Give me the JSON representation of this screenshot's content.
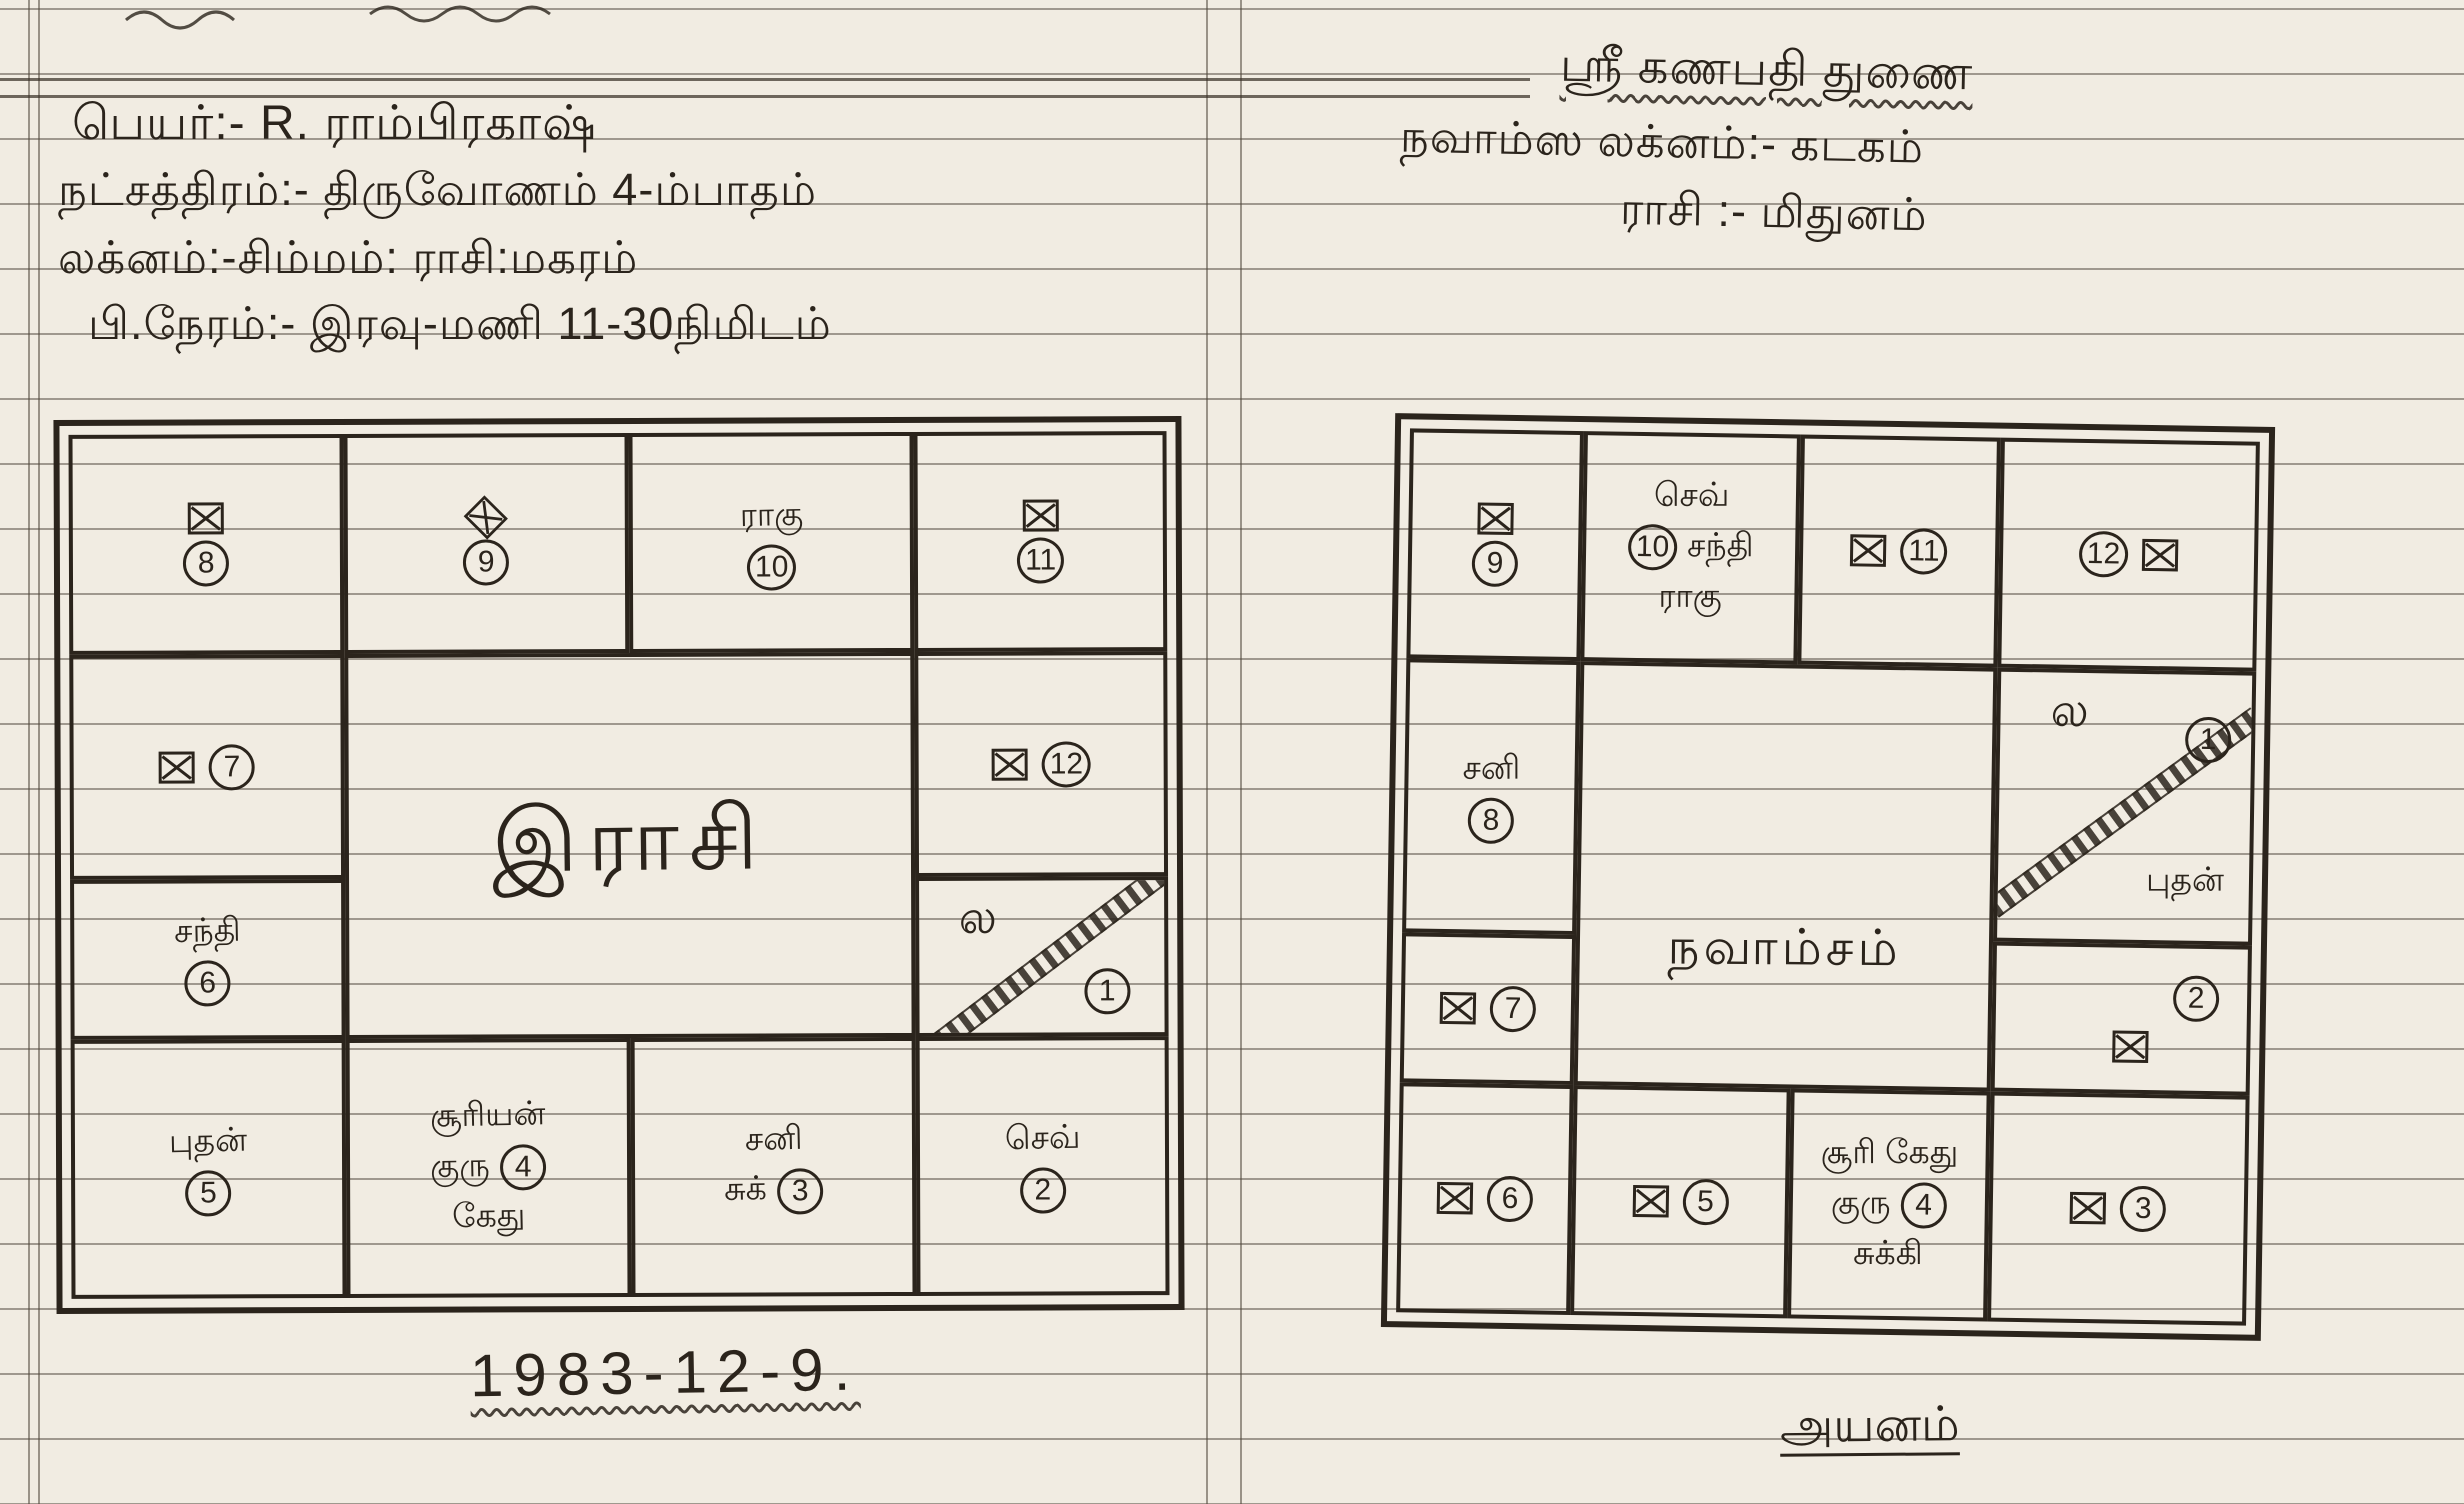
{
  "paper": {
    "background_color": "#f1ece2",
    "rule_line_color": "#4e453a",
    "ink_color": "#2b241c"
  },
  "left_page": {
    "header": {
      "line1": "பெயர்:- R. ராம்பிரகாஷ்",
      "line2": "நட்சத்திரம்:- திருவோணம் 4-ம்பாதம்",
      "line3": "லக்னம்:-சிம்மம்:   ராசி:மகரம்",
      "line4": "பி.நேரம்:- இரவு-மணி 11-30நிமிடம்"
    },
    "chart": {
      "center": "இராசி",
      "r1c1": {
        "num": "8"
      },
      "r1c2": {
        "num": "9"
      },
      "r1c3": {
        "planet": "ராகு",
        "num": "10"
      },
      "r1c4": {
        "num": "11"
      },
      "r2c1": {
        "num": "7"
      },
      "r2c4": {
        "num": "12"
      },
      "r3c1": {
        "planet": "சந்தி",
        "num": "6"
      },
      "r3c4": {
        "lagna": "ல",
        "num": "1"
      },
      "r4c1": {
        "planet": "புதன்",
        "num": "5"
      },
      "r4c2": {
        "p1": "சூரியன்",
        "p2": "குரு",
        "num": "4",
        "p3": "கேது"
      },
      "r4c3": {
        "p1": "சனி",
        "p2": "சுக்",
        "num": "3"
      },
      "r4c4": {
        "planet": "செவ்",
        "num": "2"
      }
    },
    "date": "1983-12-9."
  },
  "right_page": {
    "header": {
      "line1": "ஸ்ரீ கணபதி துணை",
      "line2": "நவாம்ஸ லக்னம்:- கடகம்",
      "line3": "ராசி  :- மிதுனம்"
    },
    "chart": {
      "center": "நவாம்சம்",
      "r1c1": {
        "num": "9"
      },
      "r1c2": {
        "p1": "செவ்",
        "num": "10",
        "p2": "சந்தி",
        "p3": "ராகு"
      },
      "r1c3": {
        "num": "11"
      },
      "r1c4": {
        "num": "12"
      },
      "r2c1": {
        "planet": "சனி",
        "num": "8"
      },
      "r2c4": {
        "lagna": "ல",
        "num": "1",
        "planet": "புதன்"
      },
      "r3c1": {
        "num": "7"
      },
      "r3c4": {
        "num": "2"
      },
      "r4c1": {
        "num": "6"
      },
      "r4c2": {
        "num": "5"
      },
      "r4c3": {
        "p1": "சூரி கேது",
        "p2": "குரு",
        "num": "4",
        "p3": "சுக்கி"
      },
      "r4c4": {
        "num": "3"
      }
    },
    "footer": "அயனம்"
  }
}
